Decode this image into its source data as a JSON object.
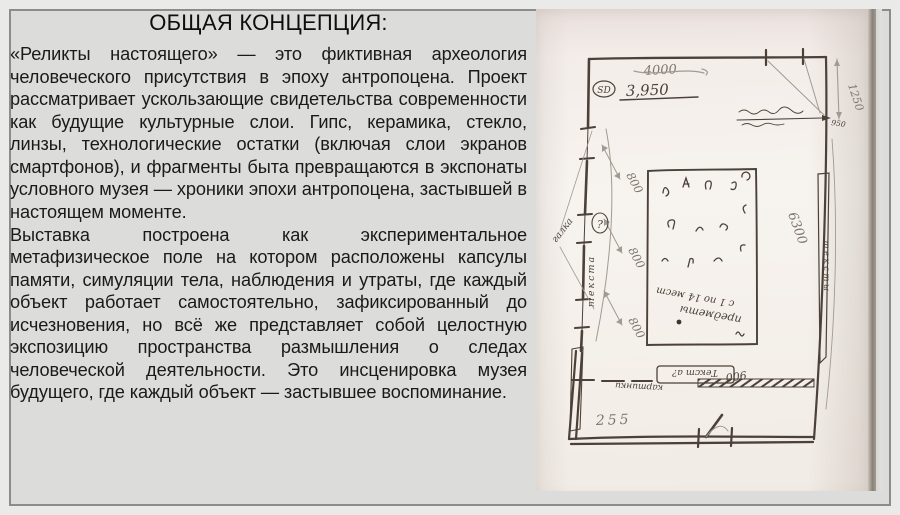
{
  "page": {
    "title": "ОБЩАЯ КОНЦЕПЦИЯ:",
    "paragraphs": [
      "«Реликты настоящего» — это фиктивная археология человеческого присутствия в эпоху антропоцена. Проект рассматривает ускользающие свидетельства современности как будущие культурные слои. Гипс, керамика, стекло, линзы, технологические остатки (включая слои экранов смартфонов), и фрагменты быта превращаются в экспонаты условного музея — хроники эпохи антропоцена, застывшей в настоящем моменте.",
      "Выставка построена как экспериментальное метафизическое поле на котором расположены капсулы памяти, симуляции тела, наблюдения и утраты, где каждый объект работает самостоятельно, зафиксированный до исчезновения, но всё же представляет собой целостную экспозицию пространства размышления о следах человеческой деятельности. Это инсценировка музея будущего, где каждый объект — застывшее воспоминание."
    ]
  },
  "sketch": {
    "description": "Рукописный план выставочного зала (скан)",
    "dim_4000": "4000",
    "dim_3950": "3,950",
    "marker_sd": "SD",
    "dim_1250": "1250",
    "dim_950": "950",
    "dim_6300": "6300",
    "dim_800_1": "800",
    "dim_800_2": "800",
    "dim_800_3": "800",
    "dim_255": "255",
    "dim_900": "900",
    "label_left_vertical": "текста",
    "label_left_question": "?",
    "label_left_diagonal": "галка",
    "label_right_strip": "тексты",
    "label_box_bottom": "Текст а?",
    "label_kartinki": "картинки",
    "note_line1": "предметы",
    "note_line2": "с 1 по 14 мест"
  }
}
